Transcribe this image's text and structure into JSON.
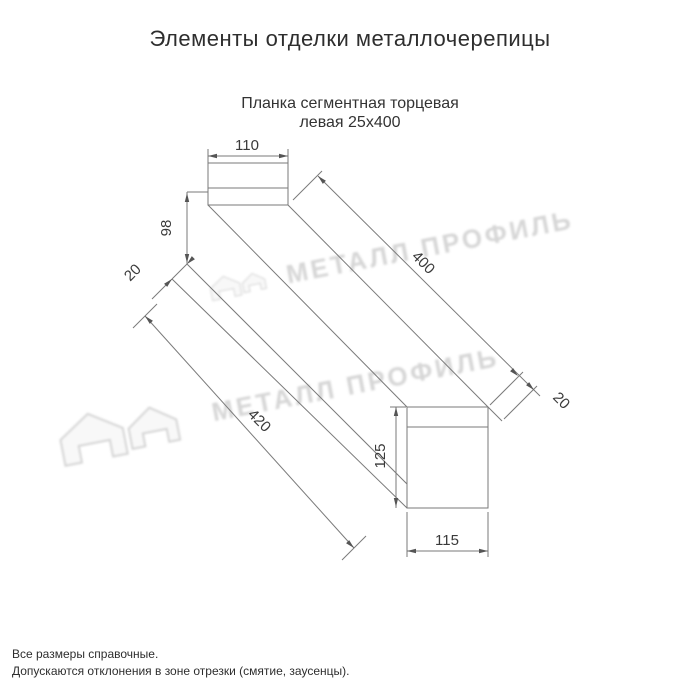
{
  "page": {
    "title": "Элементы отделки металлочерепицы"
  },
  "drawing": {
    "subtitle_line1": "Планка сегментная торцевая",
    "subtitle_line2": "левая 25х400",
    "dimensions": {
      "top_width": "110",
      "left_height": "98",
      "left_fold": "20",
      "length_top": "400",
      "right_fold": "20",
      "length_bottom": "420",
      "right_height": "125",
      "right_width": "115"
    }
  },
  "watermark": {
    "text": "МЕТАЛЛ ПРОФИЛЬ",
    "logo": "house-roof-icon"
  },
  "notes": {
    "line1": "Все размеры справочные.",
    "line2": "Допускаются отклонения в зоне отрезки (смятие, заусенцы)."
  }
}
